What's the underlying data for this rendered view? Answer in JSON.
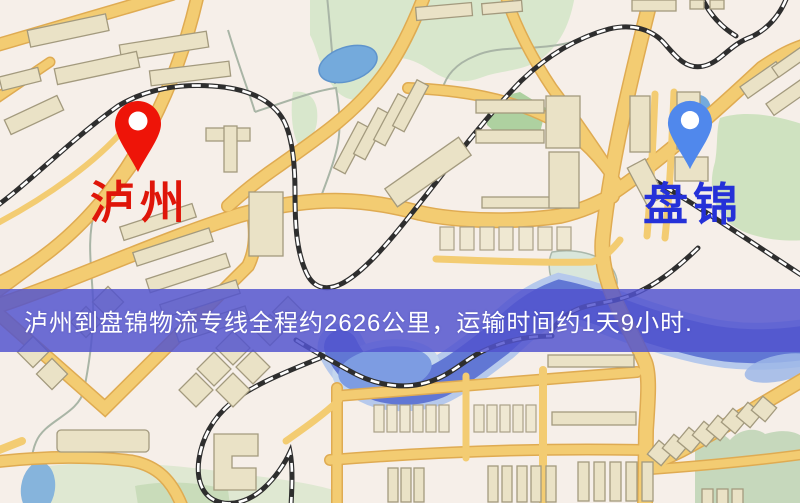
{
  "origin": {
    "name": "泸州",
    "label_color": "#df1509",
    "pin_color": "#ee1408"
  },
  "destination": {
    "name": "盘锦",
    "label_color": "#2531d8",
    "pin_color": "#5088ec"
  },
  "banner": {
    "text": "泸州到盘锦物流专线全程约2626公里，运输时间约1天9小时.",
    "distance_km": "2626",
    "duration": "1天9小时",
    "bg_color": "#5254ce",
    "text_color": "#ffffff"
  },
  "map_colors": {
    "background": "#f6efe9",
    "road_core": "#f3cc72",
    "road_edge": "#dfab52",
    "building": "#eae2c6",
    "park": "#d8e7cc",
    "pond": "#74aadc",
    "river": "#6177d4",
    "railway": "#2e2e2e"
  }
}
